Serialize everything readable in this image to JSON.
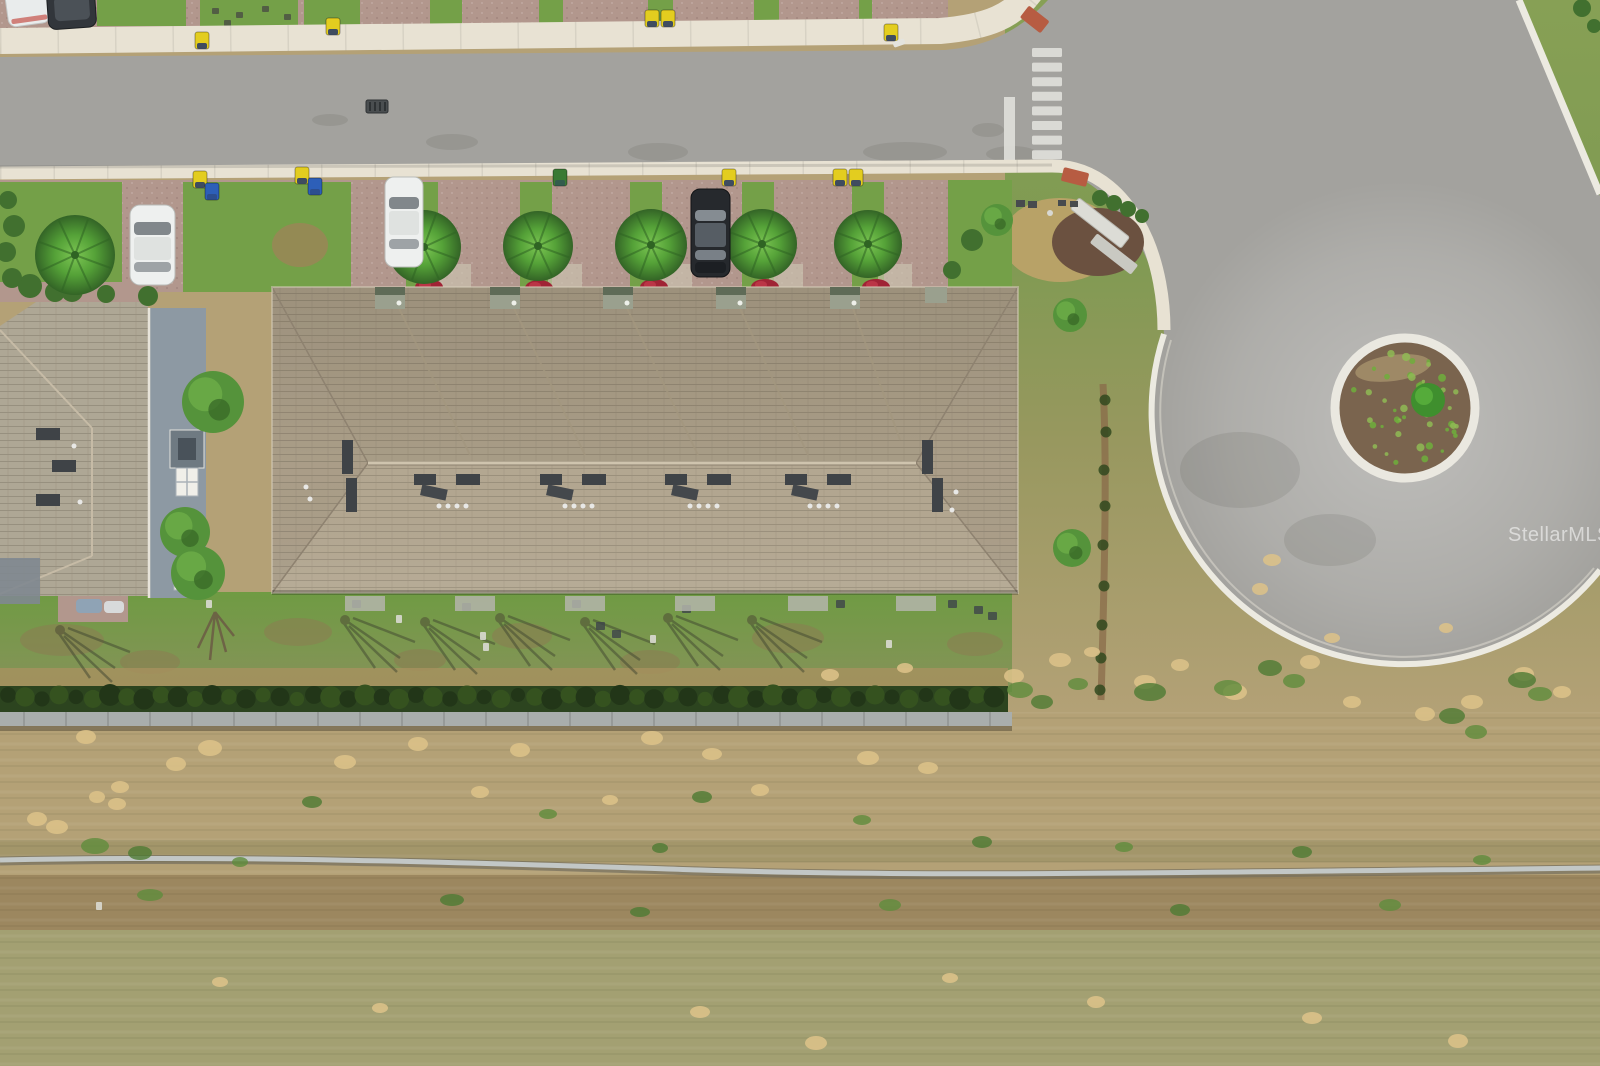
{
  "watermark": {
    "text": "StellarMLS"
  },
  "palette": {
    "asphalt": "#a3a29e",
    "asphalt_light": "#bcbbb7",
    "sidewalk": "#e8e2d3",
    "curb": "#eceae1",
    "paver": "#b2978d",
    "lawn": "#74a048",
    "lawn_back": "#6f9b43",
    "field_tan": "#b4a176",
    "field_brown": "#9c875f",
    "field_olive": "#a3a072",
    "sand": "#dcc289",
    "hedge": "#2c441f",
    "wall_gray": "#a9aeac",
    "roof": "#b3a791",
    "roof_ridge": "#cfc4ae",
    "roof_shadow": "#8e8270",
    "vent_dark": "#3f4347",
    "palm_light": "#7cc653",
    "palm": "#55a238",
    "palm_dark": "#2f6423",
    "flower_red": "#a02335",
    "mulch": "#7a644e",
    "island_bush": "#3f8f2e",
    "soil_brown": "#8a6b4a",
    "car_white": "#eef0ef",
    "car_black": "#26292d",
    "bin_yellow": "#e3cd1f",
    "bin_blue": "#2d5fb8",
    "bin_green": "#3a7a34",
    "ramp_red": "#b75c42",
    "pipe_light": "#c2c7c6",
    "pipe_dark": "#6e6a5c",
    "watermark_color": "rgba(255,255,255,0.55)"
  },
  "scene": {
    "description": "aerial drone view of townhouse building beside a cul-de-sac street",
    "crosswalk": {
      "x": 1032,
      "y": 48,
      "stripe_w": 30,
      "stripe_h": 9,
      "gap": 5.6,
      "count": 8
    },
    "palm_trees": [
      {
        "x": 424,
        "y": 247,
        "r": 37
      },
      {
        "x": 538,
        "y": 246,
        "r": 35
      },
      {
        "x": 651,
        "y": 245,
        "r": 36
      },
      {
        "x": 762,
        "y": 244,
        "r": 35
      },
      {
        "x": 868,
        "y": 244,
        "r": 34
      },
      {
        "x": 75,
        "y": 255,
        "r": 40
      }
    ],
    "flower_beds": [
      [
        429,
        287
      ],
      [
        539,
        288
      ],
      [
        654,
        287
      ],
      [
        765,
        287
      ],
      [
        876,
        287
      ]
    ],
    "grass_gaps_x": [
      406,
      520,
      630,
      742,
      852
    ],
    "north_grass": [
      [
        97,
        186
      ],
      [
        200,
        298
      ],
      [
        304,
        360
      ],
      [
        430,
        462
      ],
      [
        539,
        563
      ],
      [
        648,
        673
      ],
      [
        754,
        779
      ],
      [
        859,
        872
      ]
    ],
    "bins": [
      {
        "x": 195,
        "y": 32,
        "c": "bin_yellow"
      },
      {
        "x": 326,
        "y": 18,
        "c": "bin_yellow"
      },
      {
        "x": 645,
        "y": 10,
        "c": "bin_yellow"
      },
      {
        "x": 661,
        "y": 10,
        "c": "bin_yellow"
      },
      {
        "x": 884,
        "y": 24,
        "c": "bin_yellow"
      },
      {
        "x": 193,
        "y": 171,
        "c": "bin_yellow"
      },
      {
        "x": 205,
        "y": 183,
        "c": "bin_blue"
      },
      {
        "x": 295,
        "y": 167,
        "c": "bin_yellow"
      },
      {
        "x": 308,
        "y": 178,
        "c": "bin_blue"
      },
      {
        "x": 553,
        "y": 169,
        "c": "bin_green"
      },
      {
        "x": 722,
        "y": 169,
        "c": "bin_yellow"
      },
      {
        "x": 833,
        "y": 169,
        "c": "bin_yellow"
      },
      {
        "x": 849,
        "y": 169,
        "c": "bin_yellow"
      }
    ],
    "roof": {
      "notches_x": [
        390,
        505,
        618,
        731,
        845
      ],
      "vent_clusters_x": [
        447,
        573,
        698,
        818
      ],
      "base_hedge": [
        [
          300,
          90
        ],
        [
          482,
          46
        ],
        [
          594,
          46
        ],
        [
          706,
          46
        ],
        [
          818,
          46
        ],
        [
          922,
          58
        ]
      ]
    },
    "trees": [
      {
        "x": 213,
        "y": 402,
        "r": 31
      },
      {
        "x": 185,
        "y": 532,
        "r": 25
      },
      {
        "x": 198,
        "y": 573,
        "r": 27
      },
      {
        "x": 1070,
        "y": 315,
        "r": 17
      },
      {
        "x": 1072,
        "y": 548,
        "r": 19
      },
      {
        "x": 997,
        "y": 220,
        "r": 16
      }
    ],
    "shrubs": [
      [
        30,
        286,
        12
      ],
      [
        55,
        292,
        10
      ],
      [
        8,
        200,
        9
      ],
      [
        14,
        226,
        11
      ],
      [
        6,
        252,
        10
      ],
      [
        12,
        278,
        10
      ],
      [
        72,
        291,
        11
      ],
      [
        106,
        294,
        9
      ],
      [
        148,
        296,
        10
      ],
      [
        1100,
        198,
        8
      ],
      [
        1114,
        203,
        8
      ],
      [
        1128,
        209,
        8
      ],
      [
        1142,
        216,
        7
      ],
      [
        972,
        240,
        11
      ],
      [
        952,
        270,
        9
      ],
      [
        1582,
        8,
        9
      ],
      [
        1594,
        26,
        7
      ]
    ],
    "soil_line_clumps": [
      [
        1105,
        400
      ],
      [
        1106,
        432
      ],
      [
        1104,
        470
      ],
      [
        1105,
        506
      ],
      [
        1103,
        545
      ],
      [
        1104,
        586
      ],
      [
        1102,
        625
      ],
      [
        1101,
        658
      ],
      [
        1100,
        690
      ]
    ],
    "sand_patches": [
      [
        86,
        737,
        10,
        7
      ],
      [
        210,
        748,
        12,
        8
      ],
      [
        176,
        764,
        10,
        7
      ],
      [
        120,
        787,
        9,
        6
      ],
      [
        97,
        797,
        8,
        6
      ],
      [
        117,
        804,
        9,
        6
      ],
      [
        37,
        819,
        10,
        7
      ],
      [
        57,
        827,
        11,
        7
      ],
      [
        345,
        762,
        11,
        7
      ],
      [
        418,
        744,
        10,
        7
      ],
      [
        520,
        750,
        10,
        7
      ],
      [
        652,
        738,
        11,
        7
      ],
      [
        712,
        754,
        10,
        6
      ],
      [
        868,
        758,
        11,
        7
      ],
      [
        928,
        768,
        10,
        6
      ],
      [
        480,
        792,
        9,
        6
      ],
      [
        610,
        800,
        8,
        5
      ],
      [
        760,
        790,
        9,
        6
      ],
      [
        1060,
        660,
        11,
        7
      ],
      [
        1014,
        676,
        10,
        7
      ],
      [
        1092,
        652,
        8,
        5
      ],
      [
        1145,
        682,
        11,
        7
      ],
      [
        1180,
        665,
        9,
        6
      ],
      [
        1235,
        692,
        12,
        8
      ],
      [
        1310,
        662,
        10,
        7
      ],
      [
        1352,
        702,
        9,
        6
      ],
      [
        1425,
        714,
        10,
        7
      ],
      [
        1472,
        702,
        11,
        7
      ],
      [
        1524,
        674,
        10,
        7
      ],
      [
        1562,
        692,
        9,
        6
      ],
      [
        1332,
        638,
        8,
        5
      ],
      [
        1272,
        560,
        9,
        6
      ],
      [
        1260,
        589,
        8,
        6
      ],
      [
        830,
        675,
        9,
        6
      ],
      [
        905,
        668,
        8,
        5
      ],
      [
        700,
        1012,
        10,
        6
      ],
      [
        816,
        1043,
        11,
        7
      ],
      [
        1096,
        1002,
        9,
        6
      ],
      [
        1312,
        1018,
        10,
        6
      ],
      [
        1458,
        1041,
        10,
        7
      ],
      [
        220,
        982,
        8,
        5
      ],
      [
        380,
        1008,
        8,
        5
      ],
      [
        950,
        978,
        8,
        5
      ],
      [
        1446,
        628,
        7,
        5
      ]
    ],
    "weed_patches": [
      [
        95,
        846,
        14,
        8
      ],
      [
        140,
        853,
        12,
        7
      ],
      [
        1020,
        690,
        13,
        8
      ],
      [
        1042,
        702,
        11,
        7
      ],
      [
        1078,
        684,
        10,
        6
      ],
      [
        1150,
        692,
        16,
        9
      ],
      [
        1228,
        688,
        14,
        8
      ],
      [
        1270,
        668,
        12,
        8
      ],
      [
        1294,
        681,
        11,
        7
      ],
      [
        1452,
        716,
        13,
        8
      ],
      [
        1476,
        732,
        11,
        7
      ],
      [
        1522,
        680,
        14,
        8
      ],
      [
        1540,
        694,
        12,
        7
      ],
      [
        312,
        802,
        10,
        6
      ],
      [
        548,
        814,
        9,
        5
      ],
      [
        702,
        797,
        10,
        6
      ],
      [
        862,
        820,
        9,
        5
      ],
      [
        982,
        842,
        10,
        6
      ],
      [
        1124,
        847,
        9,
        5
      ],
      [
        1302,
        852,
        10,
        6
      ],
      [
        1482,
        860,
        9,
        5
      ],
      [
        660,
        848,
        8,
        5
      ],
      [
        240,
        862,
        8,
        5
      ],
      [
        452,
        900,
        12,
        6
      ],
      [
        890,
        905,
        11,
        6
      ],
      [
        1180,
        910,
        10,
        6
      ],
      [
        150,
        895,
        13,
        6
      ],
      [
        640,
        912,
        10,
        5
      ],
      [
        1390,
        905,
        11,
        6
      ]
    ],
    "tree_shadows": [
      [
        345,
        620
      ],
      [
        425,
        622
      ],
      [
        500,
        618
      ],
      [
        585,
        622
      ],
      [
        668,
        618
      ],
      [
        752,
        620
      ],
      [
        60,
        630
      ]
    ],
    "yard_items": [
      [
        212,
        8
      ],
      [
        236,
        12
      ],
      [
        262,
        6
      ],
      [
        284,
        14
      ],
      [
        224,
        20
      ]
    ],
    "patio_items": [
      [
        352,
        600
      ],
      [
        462,
        603
      ],
      [
        572,
        600
      ],
      [
        682,
        605
      ],
      [
        836,
        600
      ],
      [
        948,
        600
      ],
      [
        974,
        606
      ],
      [
        988,
        612
      ],
      [
        596,
        622
      ],
      [
        612,
        630
      ]
    ],
    "white_specks": [
      [
        206,
        600
      ],
      [
        396,
        615
      ],
      [
        480,
        632
      ],
      [
        483,
        643
      ],
      [
        650,
        635
      ],
      [
        886,
        640
      ],
      [
        96,
        902
      ]
    ],
    "road_stains": [
      [
        452,
        142,
        26,
        8
      ],
      [
        658,
        152,
        30,
        9
      ],
      [
        905,
        152,
        42,
        10
      ],
      [
        988,
        130,
        16,
        7
      ],
      [
        330,
        120,
        18,
        6
      ],
      [
        1012,
        154,
        26,
        8
      ],
      [
        1240,
        470,
        60,
        38
      ],
      [
        1330,
        540,
        46,
        26
      ]
    ]
  }
}
